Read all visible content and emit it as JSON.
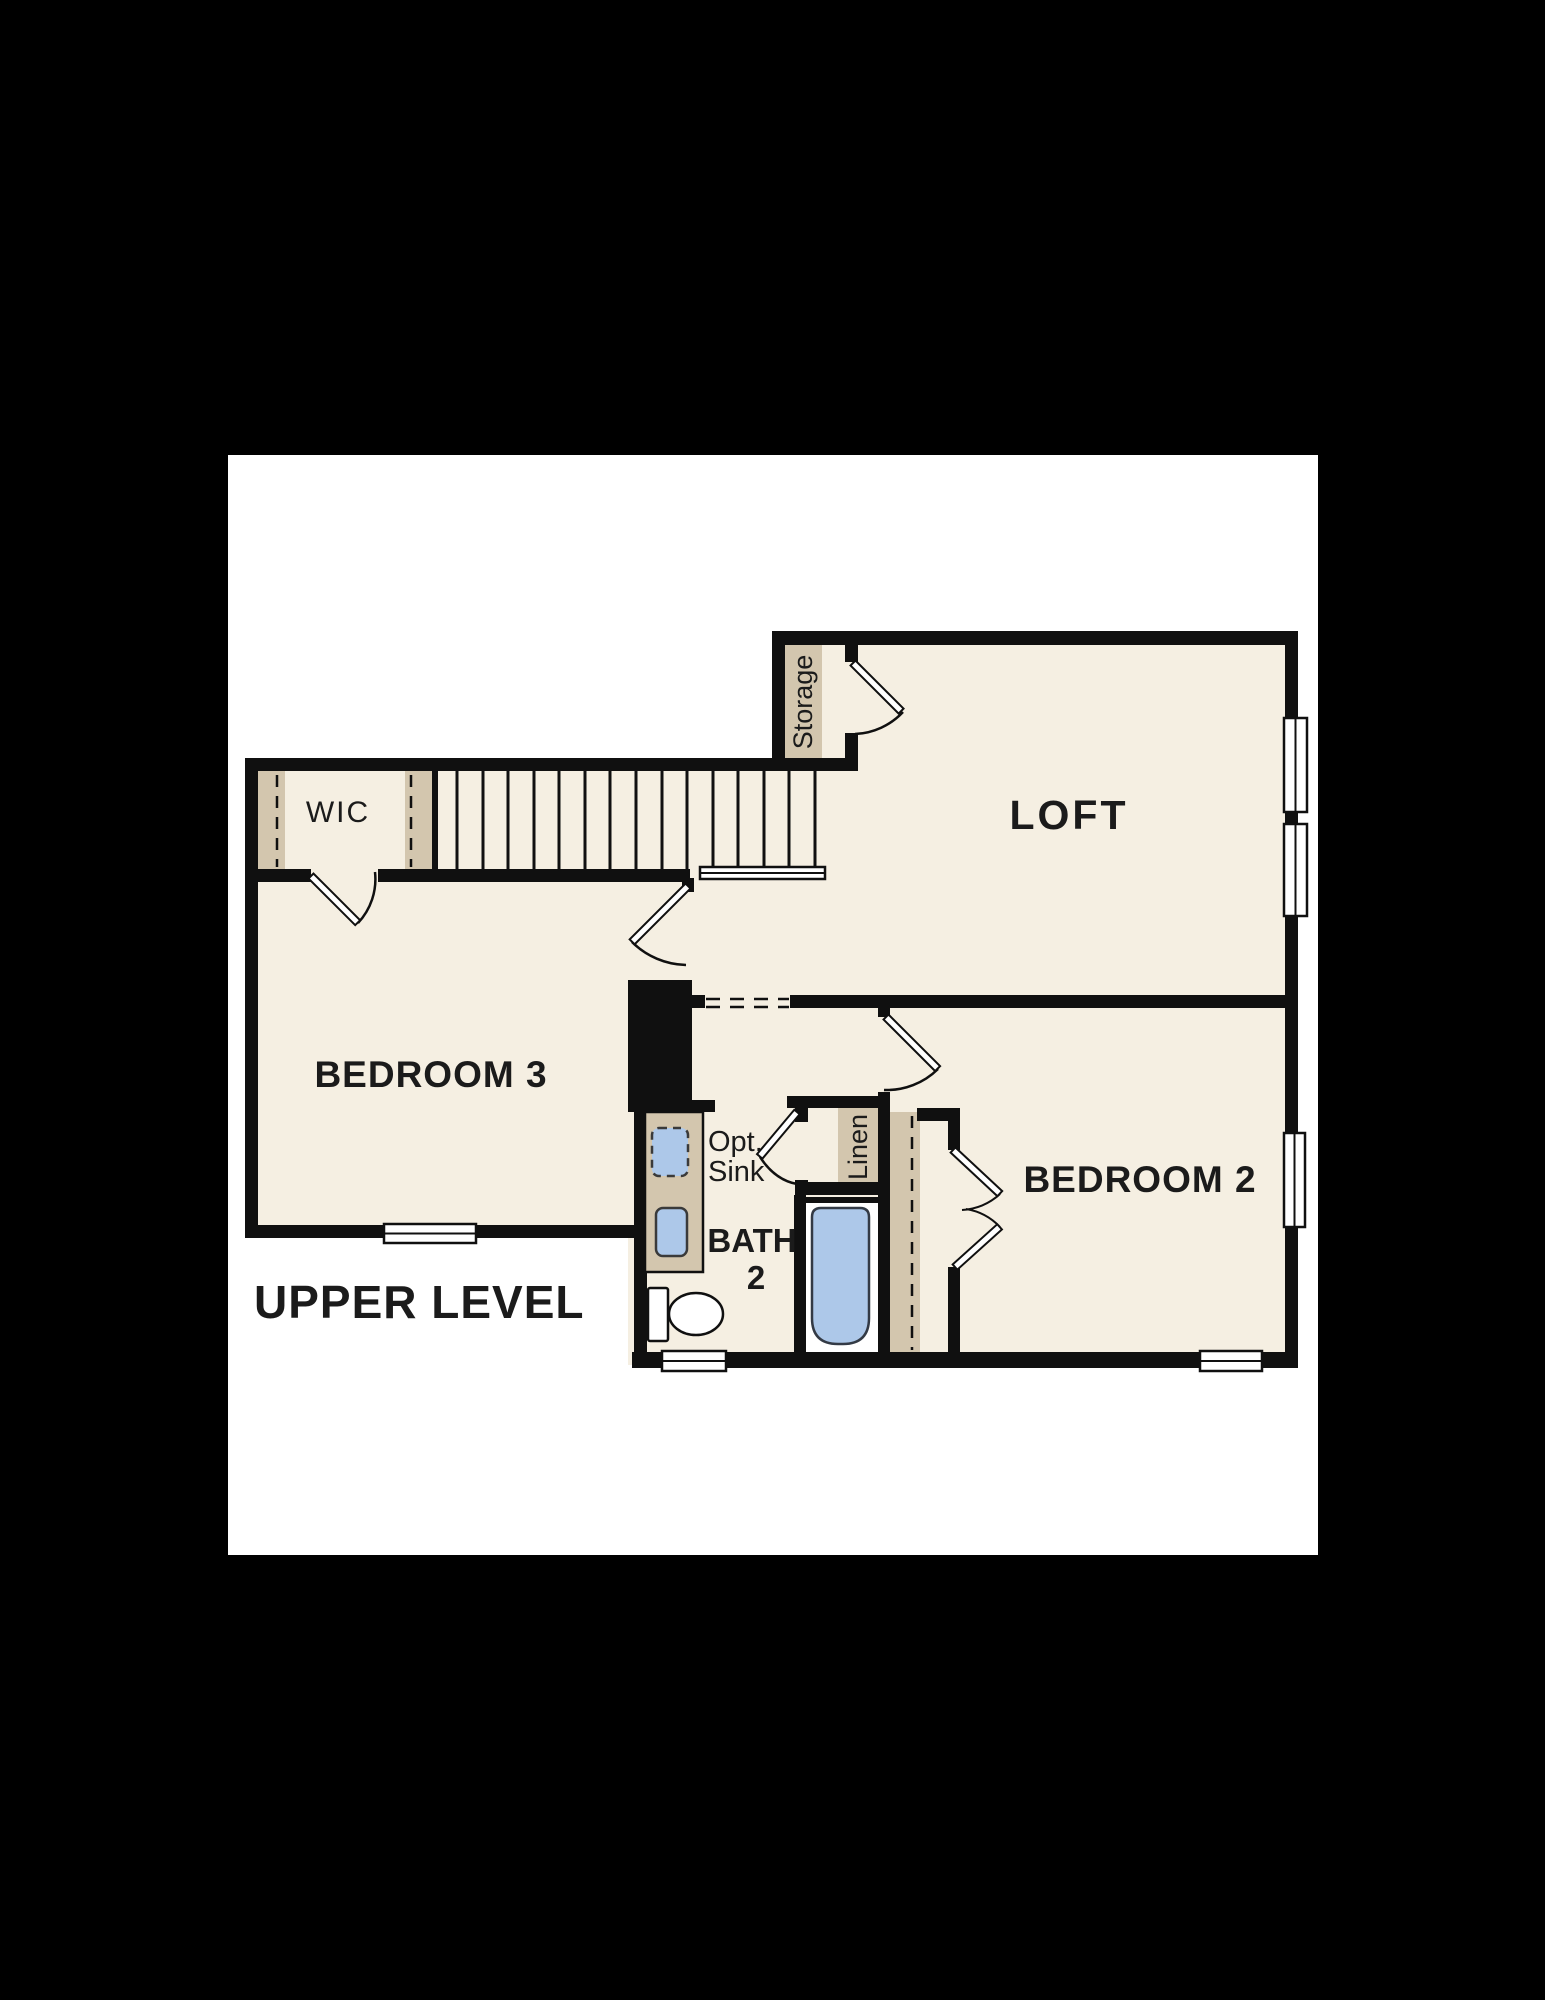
{
  "page": {
    "title": "UPPER LEVEL"
  },
  "rooms": {
    "loft": {
      "label": "LOFT"
    },
    "bedroom3": {
      "label": "BEDROOM 3"
    },
    "bedroom2": {
      "label": "BEDROOM 2"
    },
    "bath2": {
      "label_line1": "BATH",
      "label_line2": "2"
    },
    "wic": {
      "label": "WIC"
    },
    "storage": {
      "label": "Storage"
    },
    "linen": {
      "label": "Linen"
    }
  },
  "annotations": {
    "optional_sink_line1": "Opt.",
    "optional_sink_line2": "Sink"
  },
  "colors": {
    "page_background": "#000000",
    "canvas": "#ffffff",
    "floor": "#f5efe2",
    "closet_shelf_tan": "#d3c6ae",
    "wall_black": "#101010",
    "fixture_blue": "#adc8e9",
    "fixture_stroke": "#333a45",
    "label_text": "#1b1b1b"
  }
}
